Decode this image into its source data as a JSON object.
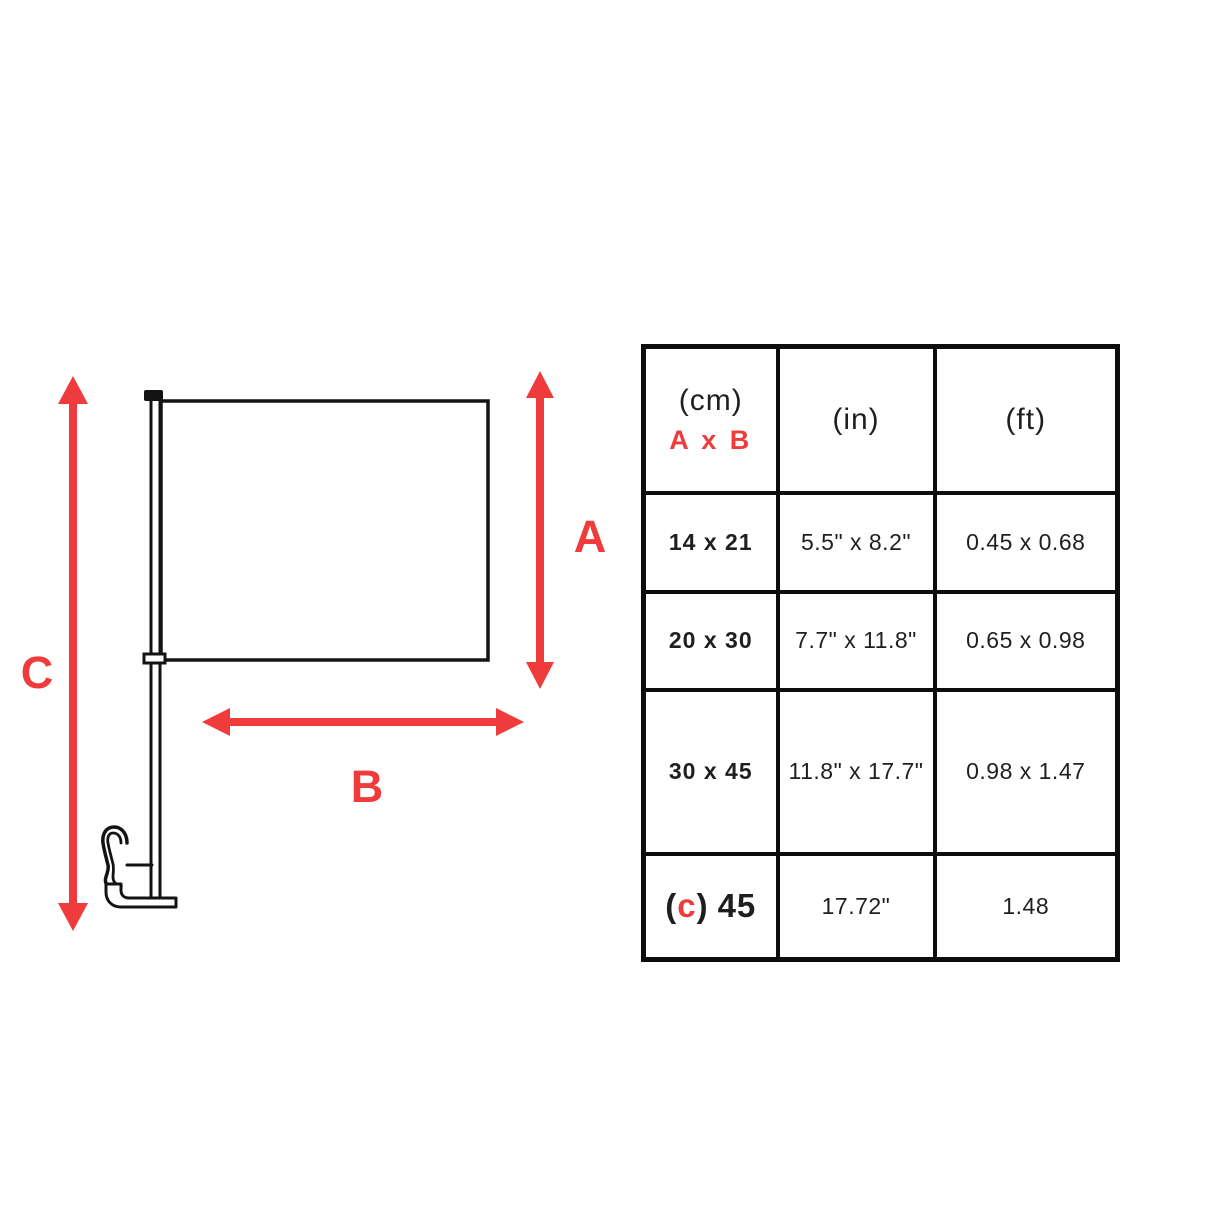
{
  "diagram": {
    "label_a": "A",
    "label_b": "B",
    "label_c": "C",
    "colors": {
      "accent_red": "#ef3b3b",
      "line_black": "#131313"
    }
  },
  "table": {
    "header": {
      "cm_unit": "(cm)",
      "axb": "A x B",
      "in_unit": "(in)",
      "ft_unit": "(ft)"
    },
    "rows": [
      {
        "cm": "14 x 21",
        "in": "5.5\" x 8.2\"",
        "ft": "0.45 x 0.68"
      },
      {
        "cm": "20 x 30",
        "in": "7.7\" x 11.8\"",
        "ft": "0.65 x 0.98"
      },
      {
        "cm": "30 x 45",
        "in": "11.8\" x 17.7\"",
        "ft": "0.98 x 1.47"
      },
      {
        "cm_open": "(",
        "cm_c": "c",
        "cm_close": ")",
        "cm_value": "45",
        "in": "17.72\"",
        "ft": "1.48"
      }
    ]
  }
}
